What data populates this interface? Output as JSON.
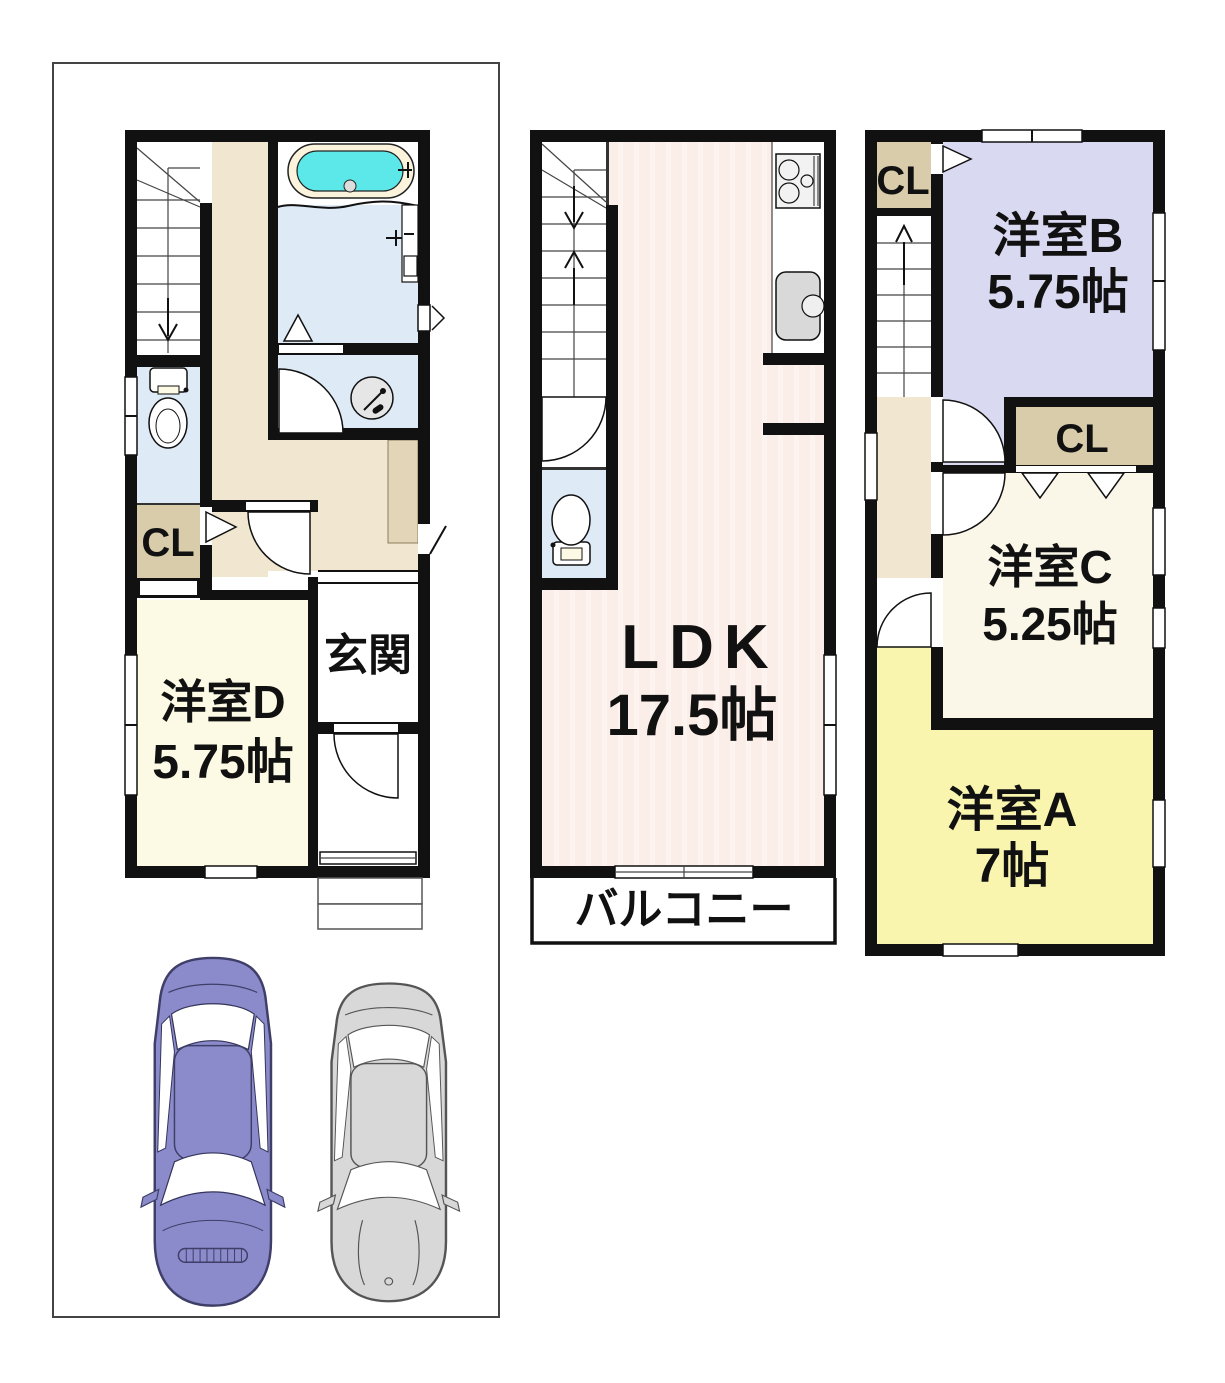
{
  "title": "3階建て住宅 間取り図",
  "colors": {
    "wall": "#111111",
    "corridor_beige": "#F1E7D0",
    "closet_tan": "#D8CCAB",
    "entrance_step_tan": "#E3D6B8",
    "room_d_ivory": "#FCFAE5",
    "room_c_ivory": "#FAF7E8",
    "room_b_lavender": "#D9D9F2",
    "room_a_yellow": "#F9F5AE",
    "ldk_pink": "#FBEDE7",
    "water_blue": "#DEEBF6",
    "bathtub_cyan": "#5CE8E8",
    "car_left": "#8B8BCB",
    "car_right": "#D8D8D8"
  },
  "floor1": {
    "closet_label": "CL",
    "entrance_label": "玄関",
    "room_d_label": "洋室D",
    "room_d_size": "5.75帖"
  },
  "floor2": {
    "ldk_label": "LDK",
    "ldk_size": "17.5帖",
    "balcony_label": "バルコニー"
  },
  "floor3": {
    "closet_top_label": "CL",
    "room_b_label": "洋室B",
    "room_b_size": "5.75帖",
    "closet_mid_label": "CL",
    "room_c_label": "洋室C",
    "room_c_size": "5.25帖",
    "room_a_label": "洋室A",
    "room_a_size": "7帖"
  }
}
